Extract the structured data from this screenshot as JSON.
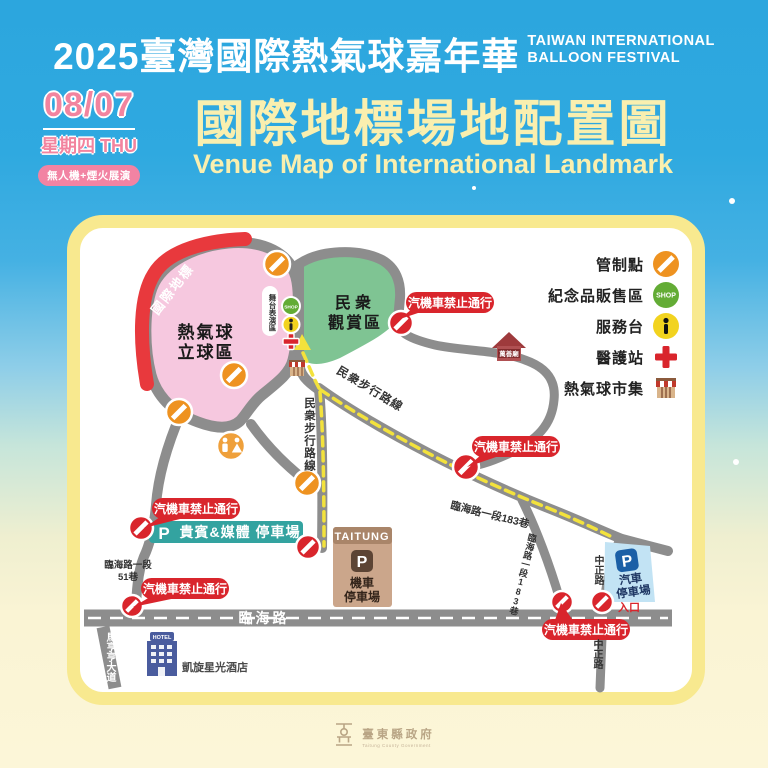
{
  "header": {
    "title_zh": "2025臺灣國際熱氣球嘉年華",
    "title_en_line1": "TAIWAN INTERNATIONAL",
    "title_en_line2": "BALLOON FESTIVAL",
    "date": "08/07",
    "weekday": "星期四 THU",
    "event_badge": "無人機+煙火展演",
    "map_title_zh": "國際地標場地配置圖",
    "map_title_en": "Venue Map of International Landmark"
  },
  "legend": {
    "items": [
      {
        "label": "管制點",
        "icon": "no-entry-icon"
      },
      {
        "label": "紀念品販售區",
        "icon": "shop-icon"
      },
      {
        "label": "服務台",
        "icon": "info-icon"
      },
      {
        "label": "醫護站",
        "icon": "medical-icon"
      },
      {
        "label": "熱氣球市集",
        "icon": "market-icon"
      }
    ]
  },
  "map": {
    "balloon_area_line1": "熱氣球",
    "balloon_area_line2": "立球區",
    "landmark_band": "國際地標",
    "stage_label": "舞台表演區",
    "viewing_area_line1": "民衆",
    "viewing_area_line2": "觀賞區",
    "no_vehicle_label": "汽機車禁止通行",
    "walk_route_diagonal": "民衆步行路線",
    "walk_route_vertical": "民衆步行路線",
    "vip_parking": "貴賓&媒體 停車場",
    "parking_p": "P",
    "taitung_label": "TAITUNG",
    "moto_parking_line1": "機車",
    "moto_parking_line2": "停車場",
    "car_parking_line1": "汽車",
    "car_parking_line2": "停車場",
    "entrance_label": "入口",
    "temple_label": "萬善廟",
    "hotel_sign": "HOTEL",
    "hotel_label": "凱旋星光酒店",
    "shop_text": "SHOP",
    "roads": {
      "linhai": "臨海路",
      "lane51_line1": "臨海路一段",
      "lane51_line2": "51巷",
      "lane183_diagonal": "臨海路一段183巷",
      "lane183_vertical": "臨海路一段183巷",
      "zhongzheng_upper": "中正路",
      "zhongzheng_lower": "中正路",
      "mahengheng": "馬亨亨大道"
    }
  },
  "footer": {
    "gov_zh": "臺東縣政府",
    "gov_en": "Taitung County Government"
  },
  "colors": {
    "background_blue": "#2EA7DE",
    "background_cream": "#FCF6D8",
    "card_border_yellow": "#F8E98F",
    "title_yellow": "#F9EFAF",
    "accent_pink": "#F283A3",
    "road_gray": "#8D8D8D",
    "route_yellow": "#F3E23C",
    "alert_red": "#D9252C",
    "control_orange": "#EE9220",
    "balloon_area_pink": "#F6C8DF",
    "landmark_red": "#E8393D",
    "viewing_green": "#7FC493",
    "vip_teal": "#33A3A0",
    "moto_tan": "#CBA68B",
    "car_lightblue": "#C2E3F4",
    "shop_green": "#63AC35",
    "info_yellow": "#F2D31F"
  }
}
